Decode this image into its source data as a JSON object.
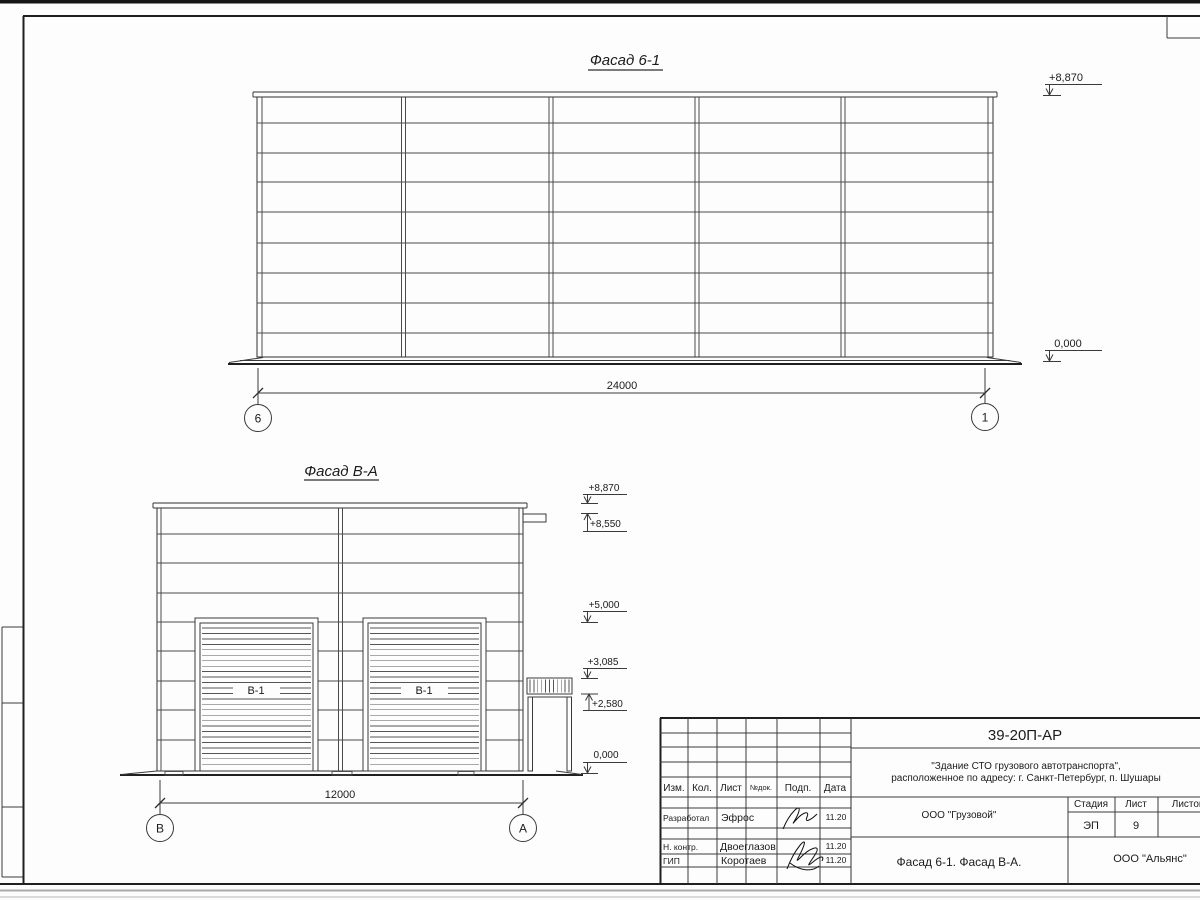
{
  "sheet": {
    "facade1": {
      "title": "Фасад 6-1",
      "dimension": "24000",
      "axis_left": "6",
      "axis_right": "1",
      "elev_top": "+8,870",
      "elev_bottom": "0,000"
    },
    "facade2": {
      "title": "Фасад В-А",
      "dimension": "12000",
      "axis_left": "В",
      "axis_right": "А",
      "door_label_1": "В-1",
      "door_label_2": "В-1",
      "elev": {
        "e8870": "+8,870",
        "e8550": "+8,550",
        "e5000": "+5,000",
        "e3085": "+3,085",
        "e2580": "+2,580",
        "e0": "0,000"
      }
    },
    "titleblock": {
      "doc_number": "39-20П-АР",
      "project_line1": "\"Здание СТО грузового автотранспорта\",",
      "project_line2": "расположенное по адресу: г. Санкт-Петербург, п. Шушары",
      "client": "ООО \"Грузовой\"",
      "sheet_title": "Фасад 6-1. Фасад В-А.",
      "organization": "ООО \"Альянс\"",
      "stage_label": "Стадия",
      "stage_value": "ЭП",
      "sheet_label": "Лист",
      "sheet_value": "9",
      "sheets_label": "Листов",
      "cols": {
        "izm": "Изм.",
        "kol": "Кол.",
        "list": "Лист",
        "ndok": "№док.",
        "podp": "Подп.",
        "data": "Дата"
      },
      "rows": [
        {
          "role": "Разработал",
          "name": "Эфрос",
          "date": "11.20"
        },
        {
          "role": "Н. контр.",
          "name": "Двоеглазов",
          "date": "11.20"
        },
        {
          "role": "ГИП",
          "name": "Коротаев",
          "date": "11.20"
        }
      ]
    }
  }
}
